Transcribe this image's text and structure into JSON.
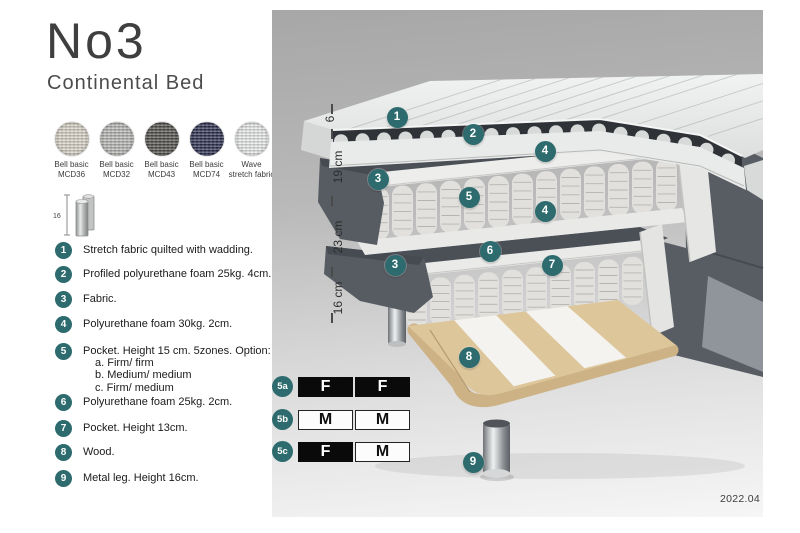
{
  "header": {
    "title": "No3",
    "subtitle": "Continental Bed"
  },
  "swatches": [
    {
      "line1": "Bell basic",
      "line2": "MCD36",
      "color": "#d8d3c7"
    },
    {
      "line1": "Bell basic",
      "line2": "MCD32",
      "color": "#b7b7b5"
    },
    {
      "line1": "Bell basic",
      "line2": "MCD43",
      "color": "#54524e"
    },
    {
      "line1": "Bell basic",
      "line2": "MCD74",
      "color": "#2d3150"
    },
    {
      "line1": "Wave",
      "line2": "stretch fabric",
      "color": "#e9ebea"
    }
  ],
  "leg_icon": {
    "label": "16"
  },
  "parts": [
    {
      "num": "1",
      "text": "Stretch fabric quilted with wadding."
    },
    {
      "num": "2",
      "text": "Profiled polyurethane foam 25kg. 4cm."
    },
    {
      "num": "3",
      "text": "Fabric."
    },
    {
      "num": "4",
      "text": "Polyurethane foam 30kg. 2cm."
    },
    {
      "num": "5",
      "text": "Pocket. Height 15 cm. 5zones. Option:",
      "options": [
        "a. Firm/ firm",
        "b. Medium/ medium",
        "c. Firm/ medium"
      ]
    },
    {
      "num": "6",
      "text": "Polyurethane foam 25kg. 2cm."
    },
    {
      "num": "7",
      "text": "Pocket. Height 13cm."
    },
    {
      "num": "8",
      "text": "Wood."
    },
    {
      "num": "9",
      "text": "Metal leg. Height 16cm."
    }
  ],
  "diagram": {
    "accent_teal": "#2e6b6e",
    "callouts": [
      {
        "n": "1",
        "x": 397,
        "y": 117
      },
      {
        "n": "2",
        "x": 473,
        "y": 134
      },
      {
        "n": "4",
        "x": 545,
        "y": 151
      },
      {
        "n": "3",
        "x": 378,
        "y": 179
      },
      {
        "n": "5",
        "x": 469,
        "y": 197
      },
      {
        "n": "4",
        "x": 545,
        "y": 211
      },
      {
        "n": "6",
        "x": 490,
        "y": 251
      },
      {
        "n": "3",
        "x": 395,
        "y": 265
      },
      {
        "n": "7",
        "x": 552,
        "y": 265
      },
      {
        "n": "8",
        "x": 469,
        "y": 357
      },
      {
        "n": "9",
        "x": 473,
        "y": 462
      }
    ],
    "dimensions": [
      {
        "label": "6",
        "x": 330,
        "y": 119
      },
      {
        "label": "19 cm",
        "x": 338,
        "y": 167
      },
      {
        "label": "23 cm",
        "x": 338,
        "y": 237
      },
      {
        "label": "16 cm",
        "x": 338,
        "y": 298
      }
    ],
    "tick_x": 331,
    "ticks": [
      [
        104,
        114
      ],
      [
        129,
        139
      ],
      [
        196,
        206
      ],
      [
        267,
        277
      ],
      [
        313,
        323
      ]
    ]
  },
  "firmness": {
    "options": [
      {
        "id": "5a",
        "cells": [
          {
            "letter": "F",
            "dark": true
          },
          {
            "letter": "F",
            "dark": true
          }
        ]
      },
      {
        "id": "5b",
        "cells": [
          {
            "letter": "M",
            "dark": false
          },
          {
            "letter": "M",
            "dark": false
          }
        ]
      },
      {
        "id": "5c",
        "cells": [
          {
            "letter": "F",
            "dark": true
          },
          {
            "letter": "M",
            "dark": false
          }
        ]
      }
    ]
  },
  "version": "2022.04"
}
